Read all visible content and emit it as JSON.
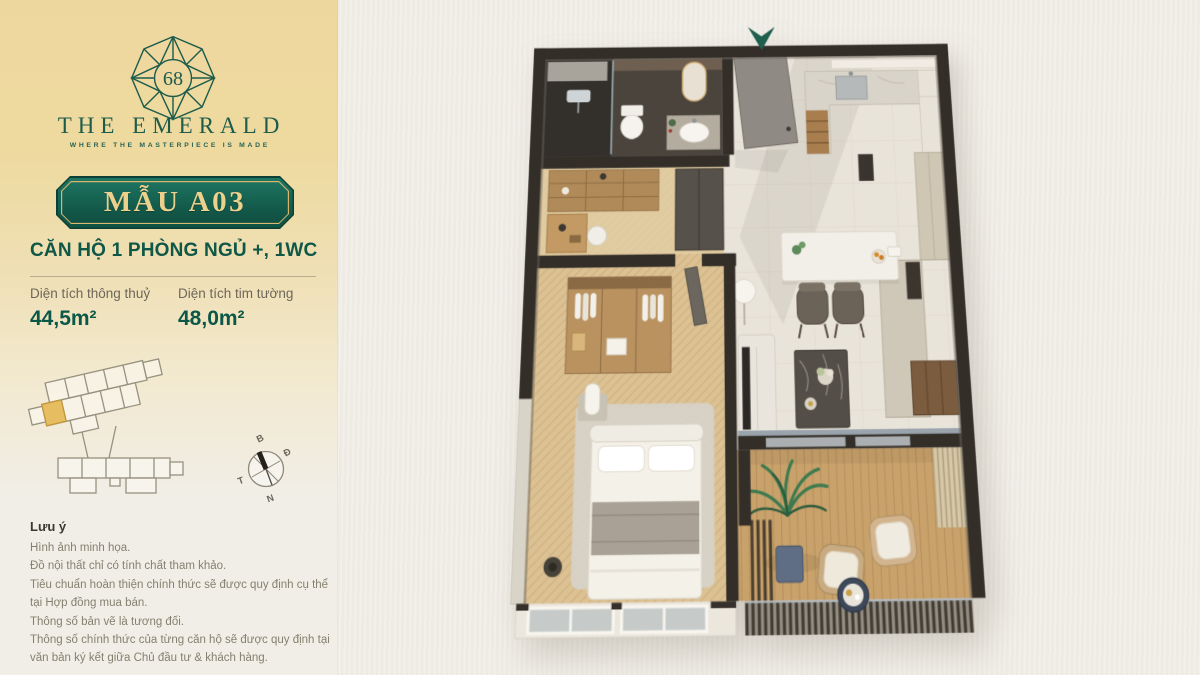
{
  "page": {
    "background": "#f1eee7"
  },
  "panel": {
    "gradient_top": "#eed79f",
    "logo": {
      "number": "68",
      "name": "THE EMERALD",
      "tagline": "WHERE THE MASTERPIECE IS MADE",
      "green": "#1d5c4b"
    },
    "badge": {
      "label": "MẪU A03",
      "bg": "#135a4b",
      "gold": "#ecd18d"
    },
    "unit_title": "CĂN HỘ 1 PHÒNG NGỦ +, 1WC",
    "areas": [
      {
        "label": "Diện tích thông thuỷ",
        "value": "44,5m²"
      },
      {
        "label": "Diện tích tim tường",
        "value": "48,0m²"
      }
    ],
    "compass": {
      "n": "B",
      "e": "Đ",
      "s": "N",
      "w": "T"
    },
    "notes": {
      "title": "Lưu ý",
      "lines": [
        "Hình ảnh minh họa.",
        "Đồ nội thất chỉ có tính chất tham khảo.",
        "Tiêu chuẩn hoàn thiện chính thức sẽ được quy định cụ thể tại Hợp đồng mua bán.",
        "Thông số bản vẽ là tương đối.",
        "Thông số chính thức của từng căn hộ sẽ được quy định tại văn bản ký kết giữa Chủ đầu tư & khách hàng."
      ]
    }
  },
  "floorplan": {
    "entrance_arrow_color": "#1e5f4e",
    "wall_color": "#332e28",
    "highlight_unit_color": "#e7bd62"
  }
}
